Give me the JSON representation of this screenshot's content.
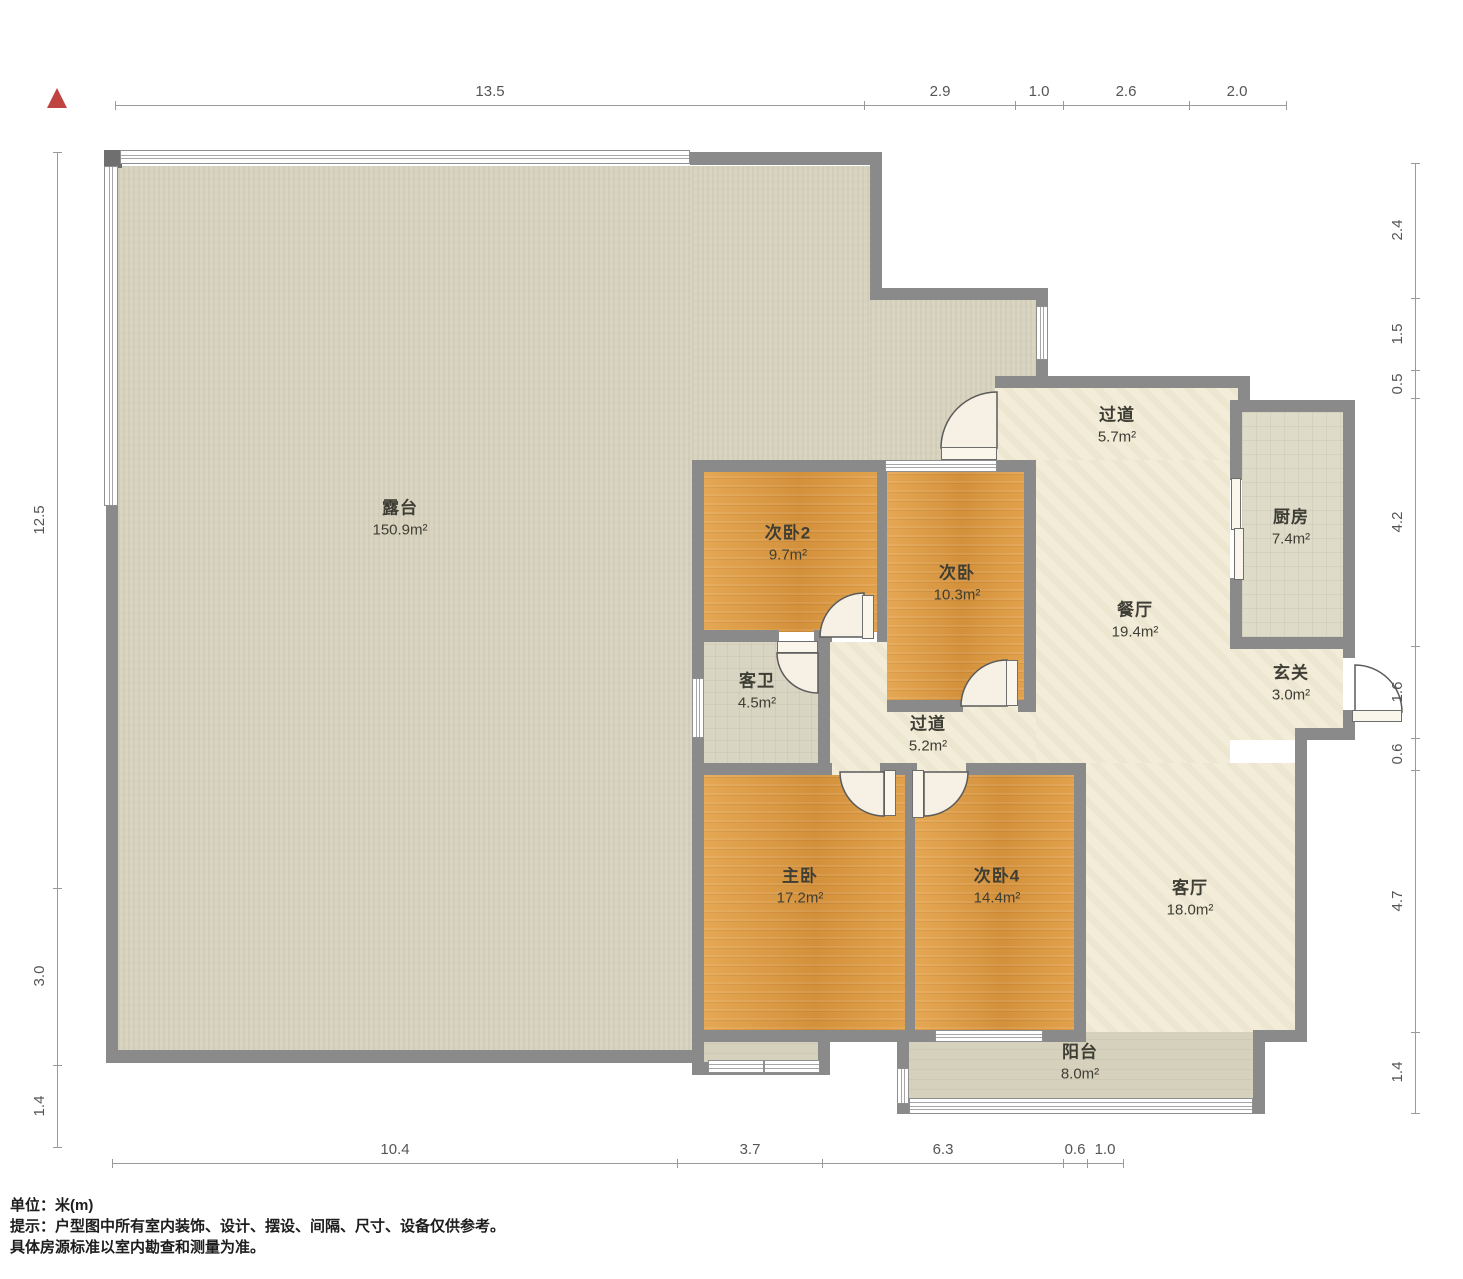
{
  "colors": {
    "wall": "#8a8a8a",
    "wood": "#d9973f",
    "terrace": "#d7d3be",
    "cream": "#f2ecd9",
    "kitchen_floor": "#dedbc8",
    "balcony": "#d5d1bc",
    "north_arrow": "#bf4340",
    "dim_text": "#555555"
  },
  "north_arrow": {
    "name": "north-indicator"
  },
  "rooms": [
    {
      "name": "露台",
      "area": "150.9m²",
      "x": 400,
      "y": 516
    },
    {
      "name": "过道",
      "area": "5.7m²",
      "x": 1117,
      "y": 423
    },
    {
      "name": "厨房",
      "area": "7.4m²",
      "x": 1291,
      "y": 525
    },
    {
      "name": "次卧2",
      "area": "9.7m²",
      "x": 788,
      "y": 541
    },
    {
      "name": "次卧",
      "area": "10.3m²",
      "x": 957,
      "y": 581
    },
    {
      "name": "餐厅",
      "area": "19.4m²",
      "x": 1135,
      "y": 618
    },
    {
      "name": "玄关",
      "area": "3.0m²",
      "x": 1291,
      "y": 681
    },
    {
      "name": "客卫",
      "area": "4.5m²",
      "x": 757,
      "y": 689
    },
    {
      "name": "过道",
      "area": "5.2m²",
      "x": 928,
      "y": 732
    },
    {
      "name": "主卧",
      "area": "17.2m²",
      "x": 800,
      "y": 884
    },
    {
      "name": "次卧4",
      "area": "14.4m²",
      "x": 997,
      "y": 884
    },
    {
      "name": "客厅",
      "area": "18.0m²",
      "x": 1190,
      "y": 896
    },
    {
      "name": "阳台",
      "area": "8.0m²",
      "x": 1080,
      "y": 1060
    }
  ],
  "dimensions": {
    "top": {
      "y": 105,
      "x1": 115,
      "x2": 1286,
      "ticks": [
        115,
        864,
        1015,
        1063,
        1189,
        1286
      ],
      "labels": [
        {
          "t": "13.5",
          "x": 490
        },
        {
          "t": "2.9",
          "x": 940
        },
        {
          "t": "1.0",
          "x": 1039
        },
        {
          "t": "2.6",
          "x": 1126
        },
        {
          "t": "2.0",
          "x": 1237
        }
      ]
    },
    "bottom": {
      "y": 1163,
      "x1": 112,
      "x2": 1123,
      "ticks": [
        112,
        677,
        822,
        1063,
        1087,
        1123
      ],
      "labels": [
        {
          "t": "10.4",
          "x": 395
        },
        {
          "t": "3.7",
          "x": 750
        },
        {
          "t": "6.3",
          "x": 943
        },
        {
          "t": "0.6",
          "x": 1075
        },
        {
          "t": "1.0",
          "x": 1105
        }
      ]
    },
    "left": {
      "x": 57,
      "y1": 152,
      "y2": 1147,
      "ticks": [
        152,
        888,
        1065,
        1147
      ],
      "labels": [
        {
          "t": "12.5",
          "y": 520
        },
        {
          "t": "3.0",
          "y": 976
        },
        {
          "t": "1.4",
          "y": 1106
        }
      ]
    },
    "right": {
      "x": 1415,
      "y1": 163,
      "y2": 1113,
      "ticks": [
        163,
        298,
        370,
        398,
        646,
        738,
        770,
        1032,
        1113
      ],
      "labels": [
        {
          "t": "2.4",
          "y": 230
        },
        {
          "t": "1.5",
          "y": 334
        },
        {
          "t": "0.5",
          "y": 384
        },
        {
          "t": "4.2",
          "y": 522
        },
        {
          "t": "1.6",
          "y": 692
        },
        {
          "t": "0.6",
          "y": 754
        },
        {
          "t": "4.7",
          "y": 901
        },
        {
          "t": "1.4",
          "y": 1072
        }
      ]
    }
  },
  "footer": {
    "line1": "单位：米(m)",
    "line2": "提示：户型图中所有室内装饰、设计、摆设、间隔、尺寸、设备仅供参考。",
    "line3": "具体房源标准以室内勘查和测量为准。"
  }
}
